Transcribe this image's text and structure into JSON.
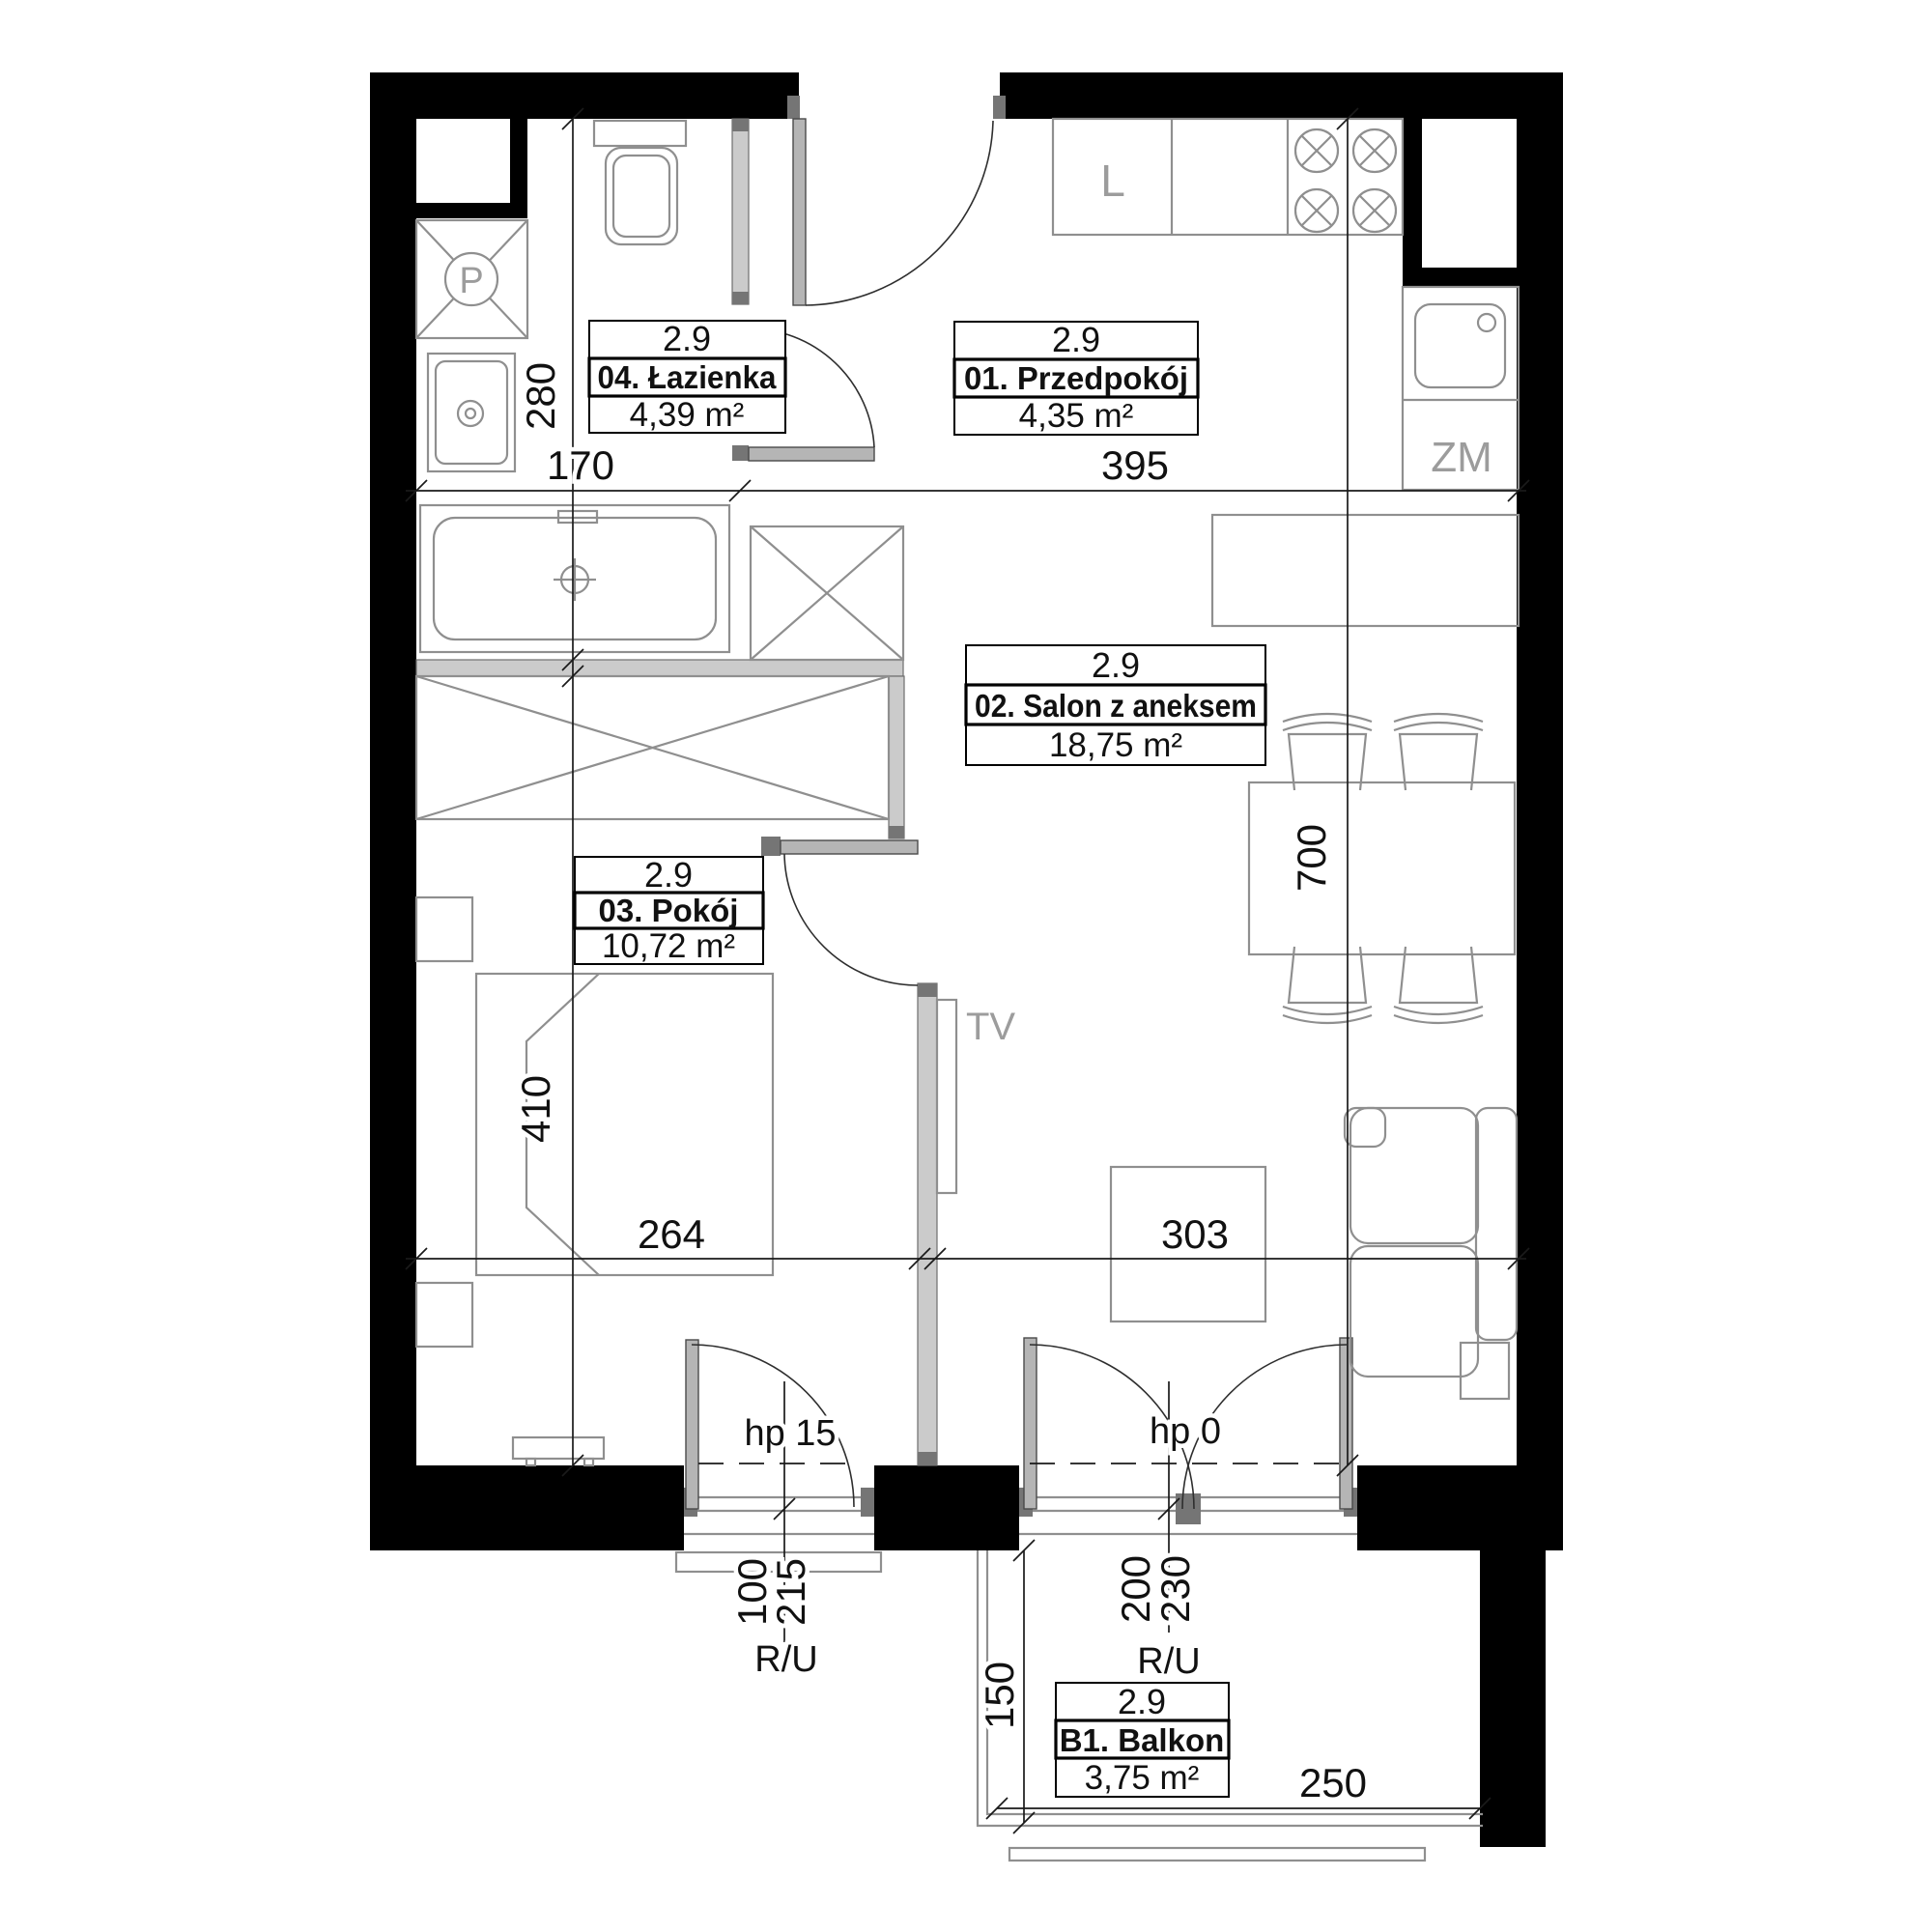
{
  "plan": {
    "rooms": [
      {
        "ceiling": "2.9",
        "name": "04. Łazienka",
        "area": "4,39 m²"
      },
      {
        "ceiling": "2.9",
        "name": "01. Przedpokój",
        "area": "4,35 m²"
      },
      {
        "ceiling": "2.9",
        "name": "02. Salon z aneksem",
        "area": "18,75 m²"
      },
      {
        "ceiling": "2.9",
        "name": "03. Pokój",
        "area": "10,72 m²"
      },
      {
        "ceiling": "2.9",
        "name": "B1. Balkon",
        "area": "3,75 m²"
      }
    ],
    "dims": {
      "d280": "280",
      "d170": "170",
      "d395": "395",
      "d700": "700",
      "d410": "410",
      "d264": "264",
      "d303": "303",
      "d150": "150",
      "d250": "250",
      "d100": "100",
      "d215": "215",
      "d200": "200",
      "d230": "230"
    },
    "openings": {
      "window_sill": "hp 15",
      "balcony_sill": "hp 0",
      "window_ru": "R/U",
      "balcony_ru": "R/U"
    },
    "appliances": {
      "washer": "P",
      "fridge": "L",
      "dishwasher": "ZM",
      "tv": "TV"
    },
    "colors": {
      "wall": "#000000",
      "partition": "#cbcbcb",
      "jamb": "#757575",
      "furniture": "#8f8f8f",
      "gray_label": "#9c9c9c",
      "dim": "#1a1a1a"
    }
  }
}
